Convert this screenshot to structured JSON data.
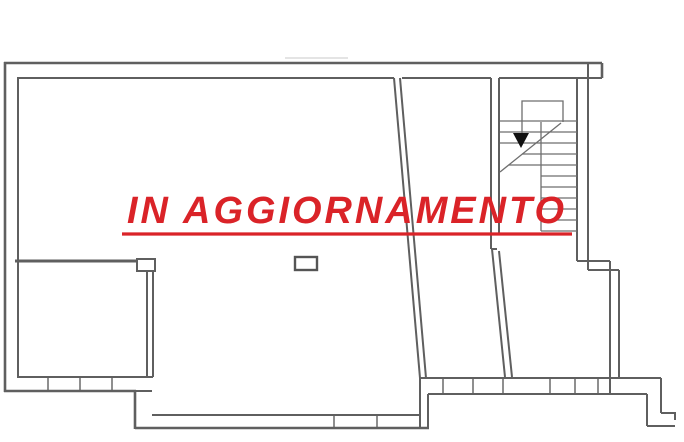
{
  "watermark": {
    "text": "IN AGGIORNAMENTO",
    "color": "#da2328",
    "underlined": true
  },
  "colors": {
    "background": "#ffffff",
    "walls": "#5f5f5f",
    "stair_lines": "#6e6e6e",
    "arrow": "#111111",
    "watermark_red": "#da2328"
  }
}
